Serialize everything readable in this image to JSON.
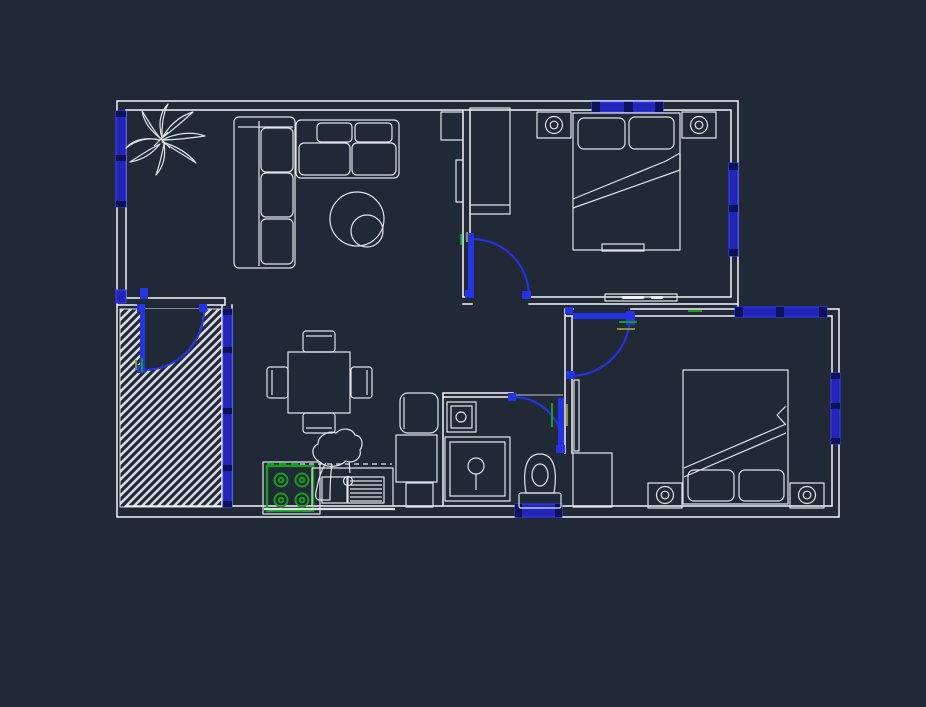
{
  "canvas": {
    "width": 926,
    "height": 707,
    "description": "CAD floor plan drawing, dark model-space canvas, no visible text labels"
  },
  "colors": {
    "background": "#212936",
    "wall_line": "#f2f4f7",
    "furn_line": "#dfe4ea",
    "window_fill": "#2126b9",
    "window_edge": "#3a3cff",
    "window_tick": "#0d1257",
    "door_blue": "#2433e6",
    "green": "#13a01c",
    "olive": "#8b9030",
    "hatch_line": "#d7dce6"
  },
  "rooms": {
    "living": "Living room",
    "dining": "Dining / kitchen area",
    "bedroom1": "Bedroom 1 (top right)",
    "bedroom2": "Bedroom 2 (bottom right)",
    "bathroom": "Bathroom",
    "terrace": "Hatched terrace / entry"
  },
  "items": {
    "plan": "Apartment floor plan",
    "walls": "Walls",
    "plant": "Potted plant",
    "sofa": "L-shaped sofa section",
    "loveseat": "Two-seat sofa",
    "coffee_table": "Round coffee tables",
    "dining_table": "Square dining table with four chairs",
    "stove": "Four-burner stove",
    "sink": "Kitchen sink with drainer",
    "faucet": "Kitchen faucet",
    "fridge": "Refrigerator",
    "cabinet": "Kitchen cabinet",
    "washbasin": "Washbasin",
    "shower": "Shower tray",
    "toilet": "Toilet",
    "bed1": "Double bed 1",
    "bed2": "Double bed 2",
    "wardrobe1": "Wardrobe bedroom 1",
    "wardrobe2": "Wardrobe bedroom 2",
    "nightstand": "Nightstand with lamp",
    "tv": "Wall panel / TV",
    "window": "Window (blue glazing)",
    "door": "Door with swing arc",
    "hatch": "Hatched floor area"
  }
}
